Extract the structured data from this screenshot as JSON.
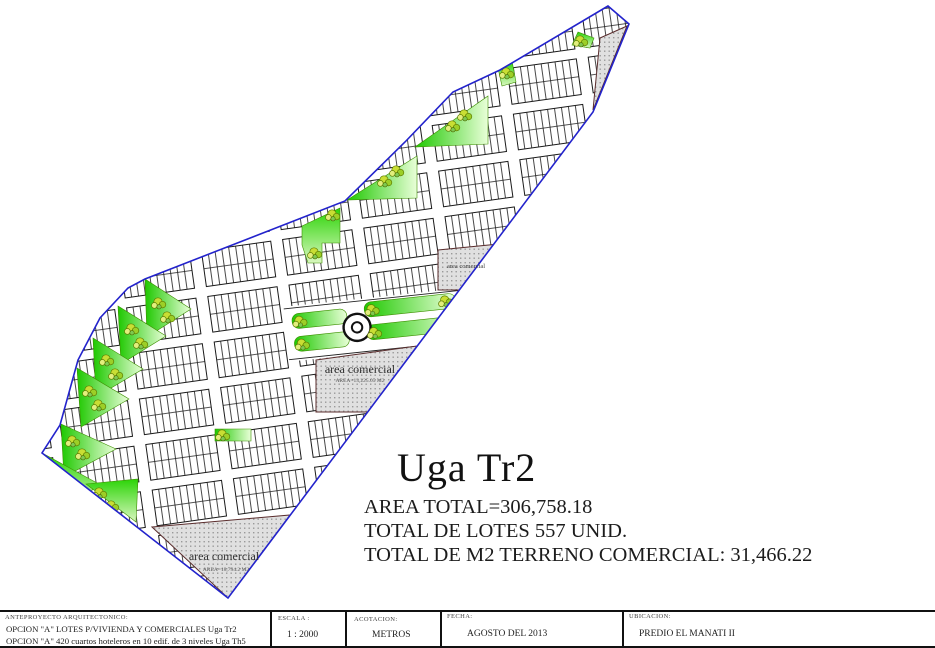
{
  "main": {
    "title": "Uga Tr2",
    "stats": [
      "AREA TOTAL=306,758.18",
      "TOTAL DE LOTES 557 UNID.",
      "TOTAL DE M2 TERRENO COMERCIAL: 31,466.22"
    ]
  },
  "plan": {
    "commercial_upper": {
      "title": "area comercial"
    },
    "commercial_mid": {
      "title": "area comercial",
      "area": "AREA=13,225.05 M2"
    },
    "commercial_bottom": {
      "title": "area comercial",
      "area": "AREA=18,794.2 M2"
    }
  },
  "titleblock": {
    "project": {
      "caption": "ANTEPROYECTO ARQUITECTONICO:",
      "line1": "OPCION \"A\" LOTES P/VIVIENDA Y COMERCIALES Uga Tr2",
      "line2": "OPCION \"A\" 420 cuartos hoteleros en 10 edif. de 3 niveles Uga Th5"
    },
    "escala": {
      "caption": "ESCALA :",
      "value": "1 : 2000"
    },
    "acotacion": {
      "caption": "ACOTACION:",
      "value": "METROS"
    },
    "fecha": {
      "caption": "FECHA:",
      "value": "AGOSTO DEL 2013"
    },
    "ubicacion": {
      "caption": "UBICACION:",
      "value": "PREDIO EL MANATI II"
    }
  },
  "colors": {
    "boundary": "#2323cc",
    "lot_lines": "#1a1a1a",
    "green_area": "#1ec800",
    "tree": "#c9de34",
    "commercial_fill": "#e0e0e0",
    "commercial_outline": "#5a2d2d"
  }
}
